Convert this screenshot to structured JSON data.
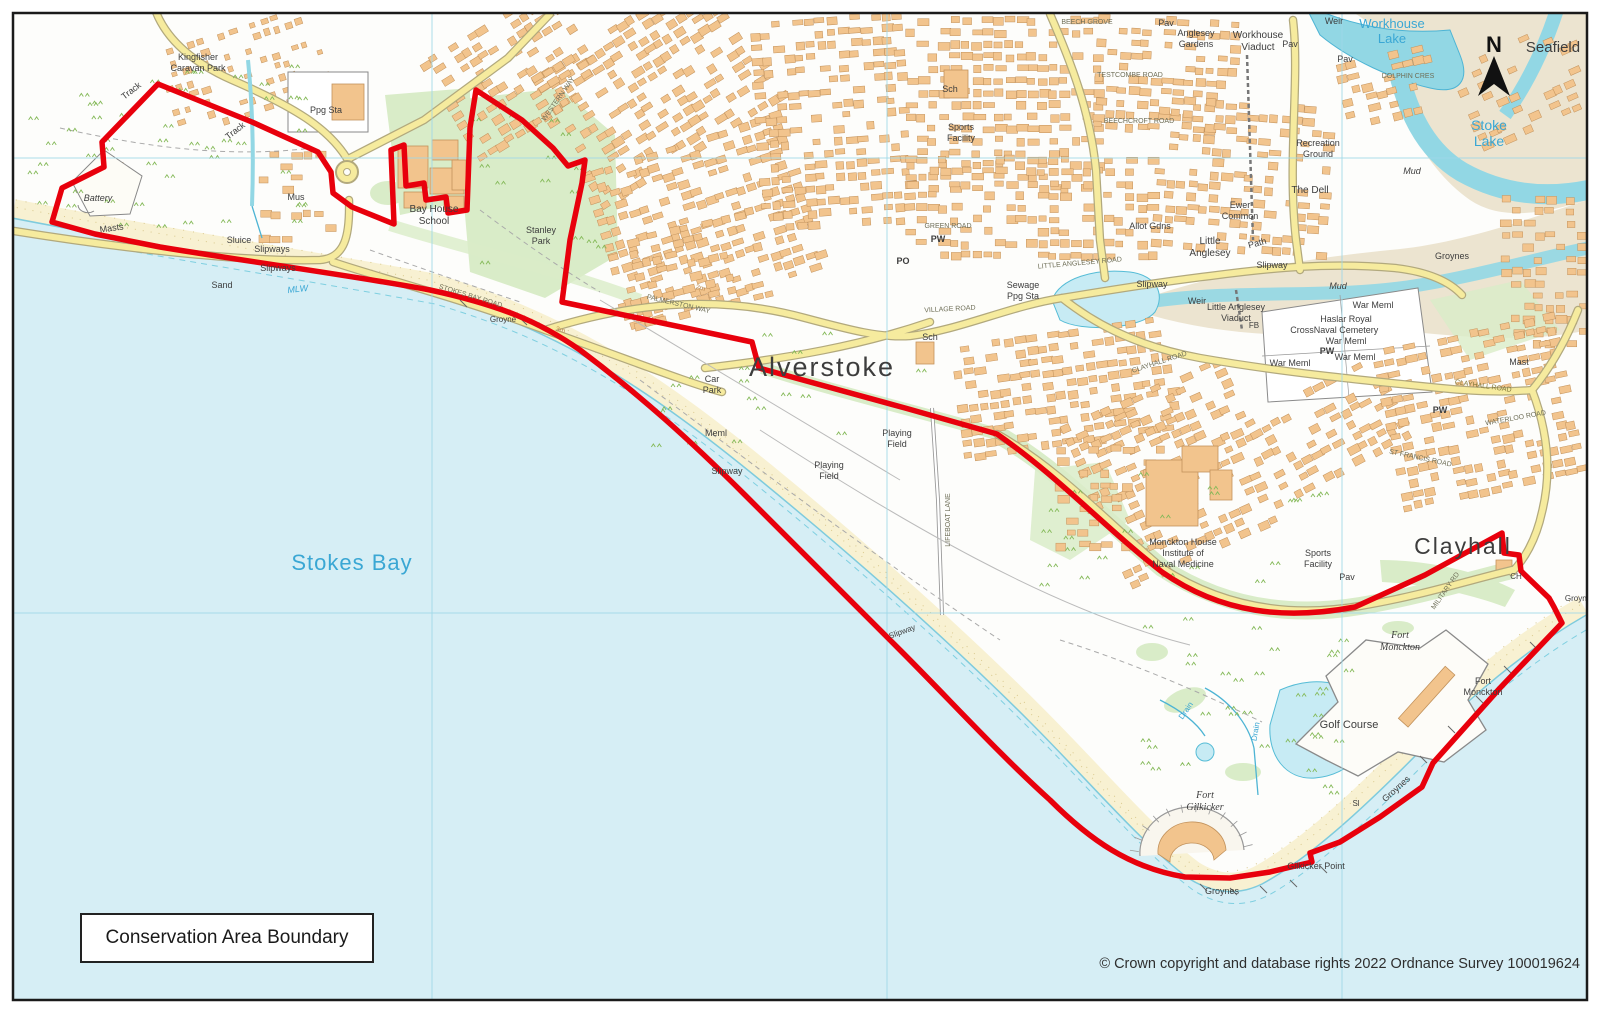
{
  "map": {
    "legend": "Conservation Area Boundary",
    "copyright": "© Crown copyright and database rights 2022 Ordnance Survey 100019624",
    "north_label": "N",
    "colors": {
      "sea": "#d6eef5",
      "sand": "#f8f1d2",
      "mud": "#ece4d0",
      "water": "#92d7e4",
      "water_line": "#4db4d4",
      "lake": "#c7ebf4",
      "building": "#f2c48d",
      "building_stroke": "#c2925c",
      "road_fill": "#f6eb9e",
      "road_casing": "#b2a97d",
      "green": "#d9ecc8",
      "tuft": "#84b958",
      "boundary": "#e8000c",
      "grid": "#9ed8e8",
      "label_dark": "#3d3d3d",
      "label_blue": "#3aa7d4",
      "road_label": "#6f6f58",
      "contour_label": "#bb8a4e"
    },
    "labels": [
      {
        "t": "Stokes Bay",
        "x": 352,
        "y": 570,
        "s": 22,
        "c": "#3aa7d4",
        "ls": 1
      },
      {
        "t": "Alverstoke",
        "x": 822,
        "y": 376,
        "s": 27,
        "ls": 2
      },
      {
        "t": "Clayhall",
        "x": 1463,
        "y": 554,
        "s": 23,
        "ls": 2
      },
      {
        "t": "Stoke Lake",
        "x": 1489,
        "y": 130,
        "s": 14,
        "c": "#3aa7d4",
        "L": [
          "Stoke",
          "Lake"
        ]
      },
      {
        "t": "Workhouse Lake",
        "x": 1392,
        "y": 28,
        "s": 13,
        "c": "#3aa7d4",
        "L": [
          "Workhouse",
          "Lake"
        ]
      },
      {
        "t": "Seafield",
        "x": 1553,
        "y": 52,
        "s": 15
      },
      {
        "t": "Kingfisher Caravan Park",
        "x": 198,
        "y": 60,
        "s": 9,
        "L": [
          "Kingfisher",
          "Caravan Park"
        ]
      },
      {
        "t": "Track",
        "x": 133,
        "y": 93,
        "s": 9,
        "r": -38
      },
      {
        "t": "Track",
        "x": 237,
        "y": 133,
        "s": 9,
        "r": -38
      },
      {
        "t": "Ppg Sta",
        "x": 326,
        "y": 113,
        "s": 9
      },
      {
        "t": "Battery",
        "x": 98,
        "y": 201,
        "s": 9,
        "i": 1
      },
      {
        "t": "Mus",
        "x": 296,
        "y": 200,
        "s": 9
      },
      {
        "t": "Masts",
        "x": 112,
        "y": 231,
        "s": 9,
        "r": -8
      },
      {
        "t": "Sluice",
        "x": 239,
        "y": 243,
        "s": 9
      },
      {
        "t": "Slipways",
        "x": 272,
        "y": 252,
        "s": 9
      },
      {
        "t": "Slipways",
        "x": 278,
        "y": 271,
        "s": 9
      },
      {
        "t": "Sand",
        "x": 222,
        "y": 288,
        "s": 9
      },
      {
        "t": "MLW",
        "x": 298,
        "y": 292,
        "s": 9,
        "c": "#3aa7d4",
        "i": 1,
        "r": -6
      },
      {
        "t": "Bay House School",
        "x": 434,
        "y": 212,
        "s": 10,
        "L": [
          "Bay House",
          "School"
        ]
      },
      {
        "t": "Stanley Park",
        "x": 541,
        "y": 233,
        "s": 9,
        "L": [
          "Stanley",
          "Park"
        ]
      },
      {
        "t": "WESTERN WAY",
        "x": 560,
        "y": 100,
        "s": 7,
        "r": -55,
        "c": "#6f6f58"
      },
      {
        "t": "STOKES BAY ROAD",
        "x": 470,
        "y": 298,
        "s": 7,
        "r": 17,
        "c": "#6f6f58"
      },
      {
        "t": "Groyne",
        "x": 503,
        "y": 322,
        "s": 8
      },
      {
        "t": "PALMERSTON WAY",
        "x": 678,
        "y": 306,
        "s": 7,
        "r": 13,
        "c": "#6f6f58"
      },
      {
        "t": "2m",
        "x": 700,
        "y": 290,
        "s": 7,
        "c": "#bb8a4e",
        "r": 15
      },
      {
        "t": "3m",
        "x": 560,
        "y": 332,
        "s": 7,
        "c": "#bb8a4e",
        "r": 15
      },
      {
        "t": "Car Park",
        "x": 712,
        "y": 382,
        "s": 9,
        "L": [
          "Car",
          "Park"
        ]
      },
      {
        "t": "Meml",
        "x": 716,
        "y": 436,
        "s": 9
      },
      {
        "t": "Slipway",
        "x": 727,
        "y": 474,
        "s": 9
      },
      {
        "t": "Playing Field",
        "x": 829,
        "y": 468,
        "s": 9,
        "L": [
          "Playing",
          "Field"
        ]
      },
      {
        "t": "Playing Field",
        "x": 897,
        "y": 436,
        "s": 9,
        "L": [
          "Playing",
          "Field"
        ]
      },
      {
        "t": "LIFEBOAT LANE",
        "x": 950,
        "y": 520,
        "s": 7,
        "r": -90,
        "c": "#6f6f58"
      },
      {
        "t": "Slipway",
        "x": 903,
        "y": 634,
        "s": 8,
        "r": -20
      },
      {
        "t": "Sch",
        "x": 950,
        "y": 92,
        "s": 9
      },
      {
        "t": "Sports Facility",
        "x": 961,
        "y": 130,
        "s": 9,
        "L": [
          "Sports",
          "Facility"
        ]
      },
      {
        "t": "GREEN ROAD",
        "x": 948,
        "y": 228,
        "s": 7,
        "c": "#6f6f58"
      },
      {
        "t": "PW",
        "x": 938,
        "y": 242,
        "s": 9,
        "b": 1
      },
      {
        "t": "PO",
        "x": 903,
        "y": 264,
        "s": 9,
        "b": 1
      },
      {
        "t": "Sewage Ppg Sta",
        "x": 1023,
        "y": 288,
        "s": 9,
        "L": [
          "Sewage",
          "Ppg Sta"
        ]
      },
      {
        "t": "VILLAGE ROAD",
        "x": 950,
        "y": 311,
        "s": 7,
        "c": "#6f6f58",
        "r": -3
      },
      {
        "t": "Sch",
        "x": 930,
        "y": 340,
        "s": 9
      },
      {
        "t": "LITTLE ANGLESEY ROAD",
        "x": 1080,
        "y": 265,
        "s": 7,
        "c": "#6f6f58",
        "r": -5
      },
      {
        "t": "BEECH GROVE",
        "x": 1087,
        "y": 24,
        "s": 7,
        "c": "#6f6f58"
      },
      {
        "t": "TESTCOMBE ROAD",
        "x": 1130,
        "y": 77,
        "s": 7,
        "c": "#6f6f58"
      },
      {
        "t": "BEECHCROFT ROAD",
        "x": 1139,
        "y": 123,
        "s": 7,
        "c": "#6f6f58"
      },
      {
        "t": "Pav",
        "x": 1166,
        "y": 26,
        "s": 9
      },
      {
        "t": "Anglesey Gardens",
        "x": 1196,
        "y": 36,
        "s": 9,
        "L": [
          "Anglesey",
          "Gardens"
        ]
      },
      {
        "t": "Workhouse Viaduct",
        "x": 1258,
        "y": 38,
        "s": 10,
        "L": [
          "Workhouse",
          "Viaduct"
        ]
      },
      {
        "t": "Weir",
        "x": 1334,
        "y": 24,
        "s": 9
      },
      {
        "t": "Pav",
        "x": 1290,
        "y": 47,
        "s": 9
      },
      {
        "t": "Pav",
        "x": 1345,
        "y": 62,
        "s": 9
      },
      {
        "t": "DOLPHIN CRES",
        "x": 1408,
        "y": 78,
        "s": 7,
        "c": "#6f6f58"
      },
      {
        "t": "Recreation Ground",
        "x": 1318,
        "y": 146,
        "s": 9,
        "L": [
          "Recreation",
          "Ground"
        ]
      },
      {
        "t": "The Dell",
        "x": 1310,
        "y": 193,
        "s": 10
      },
      {
        "t": "Mud",
        "x": 1412,
        "y": 174,
        "s": 9,
        "i": 1
      },
      {
        "t": "Ewer Common",
        "x": 1240,
        "y": 208,
        "s": 9,
        "L": [
          "Ewer",
          "Common"
        ]
      },
      {
        "t": "Allot Gdns",
        "x": 1150,
        "y": 229,
        "s": 9
      },
      {
        "t": "Little Anglesey",
        "x": 1210,
        "y": 244,
        "s": 10,
        "L": [
          "Little",
          "Anglesey"
        ]
      },
      {
        "t": "Path",
        "x": 1258,
        "y": 246,
        "s": 9,
        "r": -15
      },
      {
        "t": "Groynes",
        "x": 1452,
        "y": 259,
        "s": 9
      },
      {
        "t": "Slipway",
        "x": 1152,
        "y": 287,
        "s": 9
      },
      {
        "t": "Slipway",
        "x": 1272,
        "y": 268,
        "s": 9
      },
      {
        "t": "Mud",
        "x": 1338,
        "y": 289,
        "s": 9,
        "i": 1
      },
      {
        "t": "Weir",
        "x": 1197,
        "y": 304,
        "s": 9
      },
      {
        "t": "Little Anglesey Viaduct",
        "x": 1236,
        "y": 310,
        "s": 9,
        "L": [
          "Little Anglesey",
          "Viaduct"
        ]
      },
      {
        "t": "FB",
        "x": 1254,
        "y": 328,
        "s": 8
      },
      {
        "t": "Cross",
        "x": 1302,
        "y": 333,
        "s": 9
      },
      {
        "t": "War Meml",
        "x": 1373,
        "y": 308,
        "s": 9
      },
      {
        "t": "Haslar Royal Naval Cemetery War Meml",
        "x": 1346,
        "y": 322,
        "s": 9,
        "L": [
          "Haslar Royal",
          "Naval Cemetery",
          "War Meml"
        ]
      },
      {
        "t": "PW",
        "x": 1327,
        "y": 354,
        "s": 9,
        "b": 1
      },
      {
        "t": "War Meml",
        "x": 1290,
        "y": 366,
        "s": 9
      },
      {
        "t": "War Meml",
        "x": 1355,
        "y": 360,
        "s": 9
      },
      {
        "t": "CLAYHALL ROAD",
        "x": 1160,
        "y": 364,
        "s": 7,
        "r": -18,
        "c": "#6f6f58"
      },
      {
        "t": "Mast",
        "x": 1519,
        "y": 365,
        "s": 9
      },
      {
        "t": "CLAYHALL ROAD",
        "x": 1483,
        "y": 388,
        "s": 7,
        "r": 8,
        "c": "#83793a"
      },
      {
        "t": "PW",
        "x": 1440,
        "y": 413,
        "s": 9,
        "b": 1
      },
      {
        "t": "WATERLOO ROAD",
        "x": 1516,
        "y": 420,
        "s": 7,
        "r": -10,
        "c": "#6f6f58"
      },
      {
        "t": "ST FRANCIS ROAD",
        "x": 1420,
        "y": 460,
        "s": 7,
        "r": 12,
        "c": "#6f6f58"
      },
      {
        "t": "Monckton House Institute of Naval Medicine",
        "x": 1183,
        "y": 545,
        "s": 9,
        "L": [
          "Monckton House",
          "Institute of",
          "Naval Medicine"
        ]
      },
      {
        "t": "Sports Facility",
        "x": 1318,
        "y": 556,
        "s": 9,
        "L": [
          "Sports",
          "Facility"
        ]
      },
      {
        "t": "Pav",
        "x": 1347,
        "y": 580,
        "s": 9
      },
      {
        "t": "CH",
        "x": 1516,
        "y": 579,
        "s": 8
      },
      {
        "t": "MILITARY RD",
        "x": 1447,
        "y": 592,
        "s": 7,
        "r": -55,
        "c": "#6f6f58"
      },
      {
        "t": "Groyne",
        "x": 1578,
        "y": 601,
        "s": 8
      },
      {
        "t": "Fort Monckton",
        "x": 1400,
        "y": 638,
        "s": 10,
        "i": 1,
        "f": 1,
        "L": [
          "Fort",
          "Monckton"
        ]
      },
      {
        "t": "Fort Monckton",
        "x": 1483,
        "y": 684,
        "s": 9,
        "L": [
          "Fort",
          "Monckton"
        ]
      },
      {
        "t": "Golf Course",
        "x": 1349,
        "y": 728,
        "s": 11
      },
      {
        "t": "Drain",
        "x": 1188,
        "y": 712,
        "s": 8,
        "c": "#3aa7d4",
        "r": -55
      },
      {
        "t": "Drain",
        "x": 1258,
        "y": 732,
        "s": 8,
        "c": "#3aa7d4",
        "r": -80
      },
      {
        "t": "Fort Gilkicker",
        "x": 1205,
        "y": 798,
        "s": 10,
        "i": 1,
        "f": 1,
        "L": [
          "Fort",
          "Gilkicker"
        ]
      },
      {
        "t": "Sl",
        "x": 1356,
        "y": 806,
        "s": 8
      },
      {
        "t": "Groynes",
        "x": 1398,
        "y": 791,
        "s": 9,
        "r": -42
      },
      {
        "t": "Gilkicker Point",
        "x": 1316,
        "y": 869,
        "s": 9
      },
      {
        "t": "Groynes",
        "x": 1222,
        "y": 894,
        "s": 9
      }
    ]
  }
}
